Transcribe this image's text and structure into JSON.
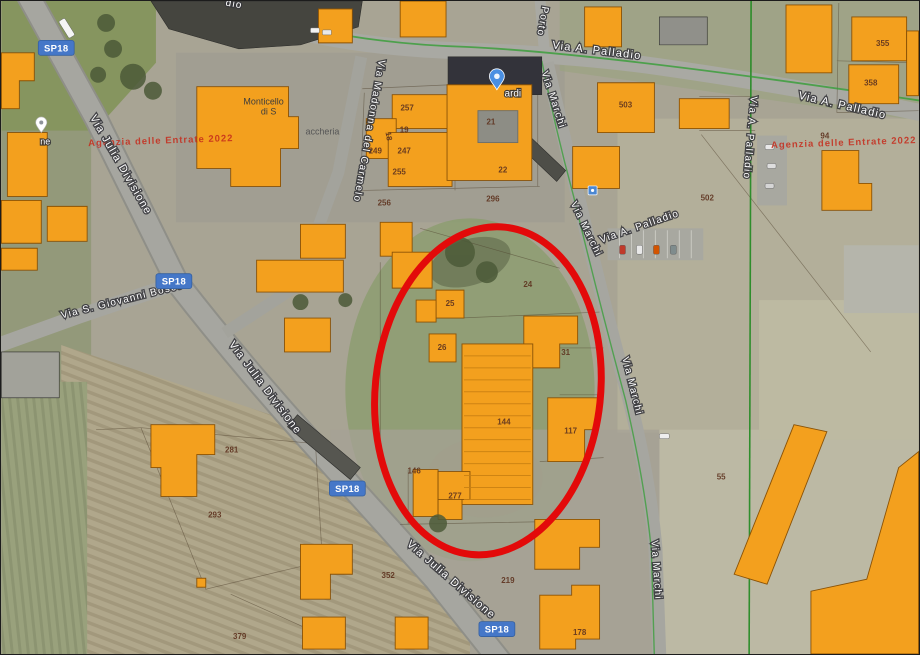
{
  "map": {
    "kind": "satellite-cadastral-overlay",
    "colors": {
      "building_fill": "#f3a01e",
      "building_stroke": "#8a5206",
      "ellipse_red": "#e30a0a",
      "badge_blue": "#4577c8",
      "boundary_green": "#2f9e2f",
      "watermark_red": "#c62b1c"
    },
    "annotation": {
      "shape": "ellipse",
      "cx": 488,
      "cy": 391,
      "rx": 113,
      "ry": 165,
      "rotation": 6,
      "stroke_width": 7
    },
    "route_badges": [
      {
        "label": "SP18",
        "x": 55,
        "y": 47
      },
      {
        "label": "SP18",
        "x": 173,
        "y": 281
      },
      {
        "label": "SP18",
        "x": 347,
        "y": 489
      },
      {
        "label": "SP18",
        "x": 497,
        "y": 630
      }
    ],
    "street_labels": [
      {
        "t": "Via Julia Divisione",
        "x": 117,
        "y": 166,
        "r": 60,
        "s": 11
      },
      {
        "t": "Via Julia Divisione",
        "x": 262,
        "y": 390,
        "r": 53,
        "s": 11
      },
      {
        "t": "Via Julia Divisione",
        "x": 449,
        "y": 583,
        "r": 41,
        "s": 11
      },
      {
        "t": "Via S. Giovanni Bosco",
        "x": 122,
        "y": 303,
        "r": -14,
        "s": 10
      },
      {
        "t": "Via Madonna del Carmelo",
        "x": 366,
        "y": 130,
        "r": 100,
        "s": 10
      },
      {
        "t": "Via A. Palladio",
        "x": 597,
        "y": 53,
        "r": 7,
        "s": 11
      },
      {
        "t": "Via A. Palladio",
        "x": 843,
        "y": 108,
        "r": 13,
        "s": 11
      },
      {
        "t": "Via A. Palladio",
        "x": 748,
        "y": 137,
        "r": 95,
        "s": 10
      },
      {
        "t": "Via A. Palladio",
        "x": 641,
        "y": 229,
        "r": -19,
        "s": 10
      },
      {
        "t": "Via Marchi",
        "x": 551,
        "y": 100,
        "r": 72,
        "s": 10
      },
      {
        "t": "Via Marchi",
        "x": 584,
        "y": 230,
        "r": 64,
        "s": 10
      },
      {
        "t": "Via Marchi",
        "x": 630,
        "y": 387,
        "r": 76,
        "s": 10
      },
      {
        "t": "Via Marchi",
        "x": 654,
        "y": 571,
        "r": 86,
        "s": 10
      },
      {
        "t": "Porto",
        "x": 540,
        "y": 20,
        "r": 100,
        "s": 10
      },
      {
        "t": "dio",
        "x": 233,
        "y": 6,
        "r": 10,
        "s": 10
      }
    ],
    "watermarks": [
      {
        "t": "Agenzia delle Entrate 2022",
        "x": 160,
        "y": 143,
        "r": -2
      },
      {
        "t": "Agenzia delle Entrate 2022",
        "x": 845,
        "y": 145,
        "r": -2
      }
    ],
    "poi_labels": [
      {
        "t": "Monticello",
        "x": 263,
        "y": 104,
        "c": "#3c3c3c",
        "s": 9,
        "halo": false
      },
      {
        "t": "di S",
        "x": 268,
        "y": 114,
        "c": "#3c3c3c",
        "s": 9,
        "halo": false
      },
      {
        "t": "accheria",
        "x": 322,
        "y": 134,
        "c": "#565656",
        "s": 9,
        "halo": false
      },
      {
        "t": "ardi",
        "x": 513,
        "y": 96,
        "c": "#ffffff",
        "s": 10,
        "halo": true
      },
      {
        "t": "ne",
        "x": 44,
        "y": 144,
        "c": "#ffffff",
        "s": 9,
        "halo": true
      }
    ],
    "parcel_numbers": [
      {
        "t": "257",
        "x": 407,
        "y": 110
      },
      {
        "t": "19",
        "x": 404,
        "y": 132
      },
      {
        "t": "18",
        "x": 386,
        "y": 136,
        "r": 80
      },
      {
        "t": "249",
        "x": 375,
        "y": 153
      },
      {
        "t": "247",
        "x": 404,
        "y": 153
      },
      {
        "t": "255",
        "x": 399,
        "y": 174
      },
      {
        "t": "21",
        "x": 491,
        "y": 124
      },
      {
        "t": "22",
        "x": 503,
        "y": 172
      },
      {
        "t": "256",
        "x": 384,
        "y": 205
      },
      {
        "t": "296",
        "x": 493,
        "y": 201
      },
      {
        "t": "24",
        "x": 528,
        "y": 287
      },
      {
        "t": "25",
        "x": 450,
        "y": 306
      },
      {
        "t": "26",
        "x": 442,
        "y": 350
      },
      {
        "t": "31",
        "x": 566,
        "y": 355
      },
      {
        "t": "144",
        "x": 504,
        "y": 425
      },
      {
        "t": "117",
        "x": 571,
        "y": 434
      },
      {
        "t": "146",
        "x": 414,
        "y": 474
      },
      {
        "t": "277",
        "x": 455,
        "y": 499
      },
      {
        "t": "352",
        "x": 388,
        "y": 579
      },
      {
        "t": "219",
        "x": 508,
        "y": 584
      },
      {
        "t": "178",
        "x": 580,
        "y": 636
      },
      {
        "t": "281",
        "x": 231,
        "y": 453
      },
      {
        "t": "293",
        "x": 214,
        "y": 518
      },
      {
        "t": "379",
        "x": 239,
        "y": 640
      },
      {
        "t": "355",
        "x": 884,
        "y": 45
      },
      {
        "t": "358",
        "x": 872,
        "y": 85
      },
      {
        "t": "503",
        "x": 626,
        "y": 107
      },
      {
        "t": "502",
        "x": 708,
        "y": 200
      },
      {
        "t": "94",
        "x": 826,
        "y": 138
      },
      {
        "t": "55",
        "x": 722,
        "y": 480
      }
    ],
    "markers": [
      {
        "kind": "pin",
        "name": "blue-map-pin",
        "x": 497,
        "y": 89,
        "color": "#4a8fe2"
      },
      {
        "kind": "dotpin",
        "name": "white-poi-pin",
        "x": 40,
        "y": 132,
        "color": "#ffffff"
      },
      {
        "kind": "square",
        "name": "transit-stop-icon",
        "x": 593,
        "y": 190,
        "color": "#4b87d2"
      }
    ]
  }
}
